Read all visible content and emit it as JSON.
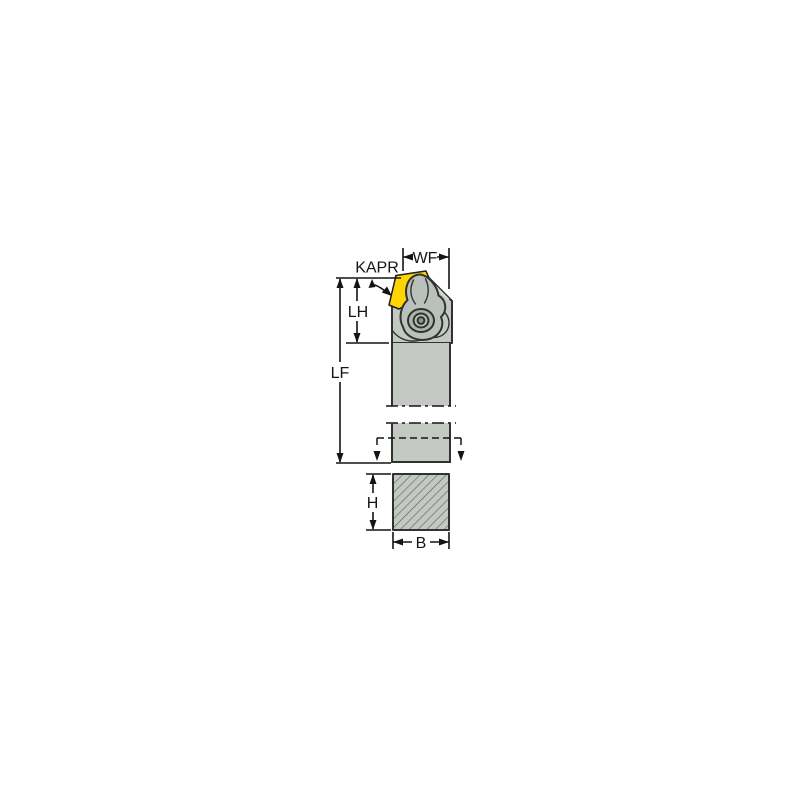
{
  "drawing": {
    "labels": {
      "kapr": "KAPR",
      "wf": "WF",
      "lh": "LH",
      "lf": "LF",
      "h": "H",
      "b": "B"
    }
  },
  "colors": {
    "background": "#FFFFFF",
    "body": "#C3C8C3",
    "clamp": "#BAC0BA",
    "screw": "#AEB4AE",
    "screwdark": "#8F958F",
    "insert": "#FFD400",
    "outline": "#2E332F",
    "facet": "#D9DDD8",
    "dim": "#141414",
    "text": "#141414",
    "hatch": "#60665F"
  }
}
